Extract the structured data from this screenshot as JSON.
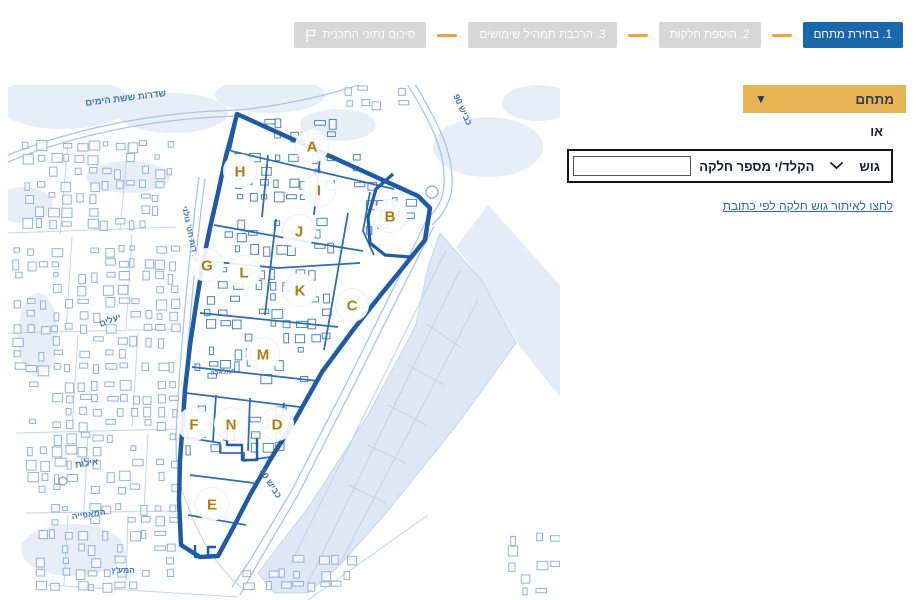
{
  "stepper": {
    "steps": [
      {
        "id": "step-1",
        "label": "1. בחירת מתחם",
        "state": "active"
      },
      {
        "id": "step-2",
        "label": "2. הוספת חלקות",
        "state": "inactive"
      },
      {
        "id": "step-3",
        "label": "3. הרכבת תמהיל שימושים",
        "state": "inactive"
      },
      {
        "id": "step-summary",
        "label": "סיכום נתוני התכנית",
        "state": "inactive",
        "icon": "flag-icon"
      }
    ],
    "connector_color": "#f2a137",
    "active_bg": "#1a67ab",
    "inactive_bg": "#d7d7d7"
  },
  "panel": {
    "mitcham_label": "מתחם",
    "or_label": "או",
    "gush_label": "גוש",
    "parcel_label": "הקלד/י מספר חלקה",
    "parcel_input_value": "",
    "address_link": "לחצו לאיתור גוש חלקה לפי כתובת",
    "accent_color": "#e9b453"
  },
  "map": {
    "zones": [
      "A",
      "H",
      "I",
      "B",
      "J",
      "G",
      "L",
      "K",
      "C",
      "M",
      "F",
      "N",
      "D",
      "E"
    ],
    "zone_letter_color": "#b5790f",
    "boundary_color": "#1d5ba6",
    "street_label_color": "#3f74b8",
    "street_labels": [
      {
        "id": "sderot-sheshet-hayamim",
        "text": "שדרות ששת הימים"
      },
      {
        "id": "kvish-90-north",
        "text": "כביש 90"
      },
      {
        "id": "sderot-hativat-golani",
        "text": "שדרות חט' גולני"
      },
      {
        "id": "yeelim",
        "text": "יעלים"
      },
      {
        "id": "eilot",
        "text": "אילות"
      },
      {
        "id": "hamaafia",
        "text": "המאפייה"
      },
      {
        "id": "hamaatz",
        "text": "המע'ץ"
      },
      {
        "id": "hamelacha",
        "text": "המלאכה"
      },
      {
        "id": "kvish-90-south",
        "text": "כביש 90"
      }
    ]
  }
}
